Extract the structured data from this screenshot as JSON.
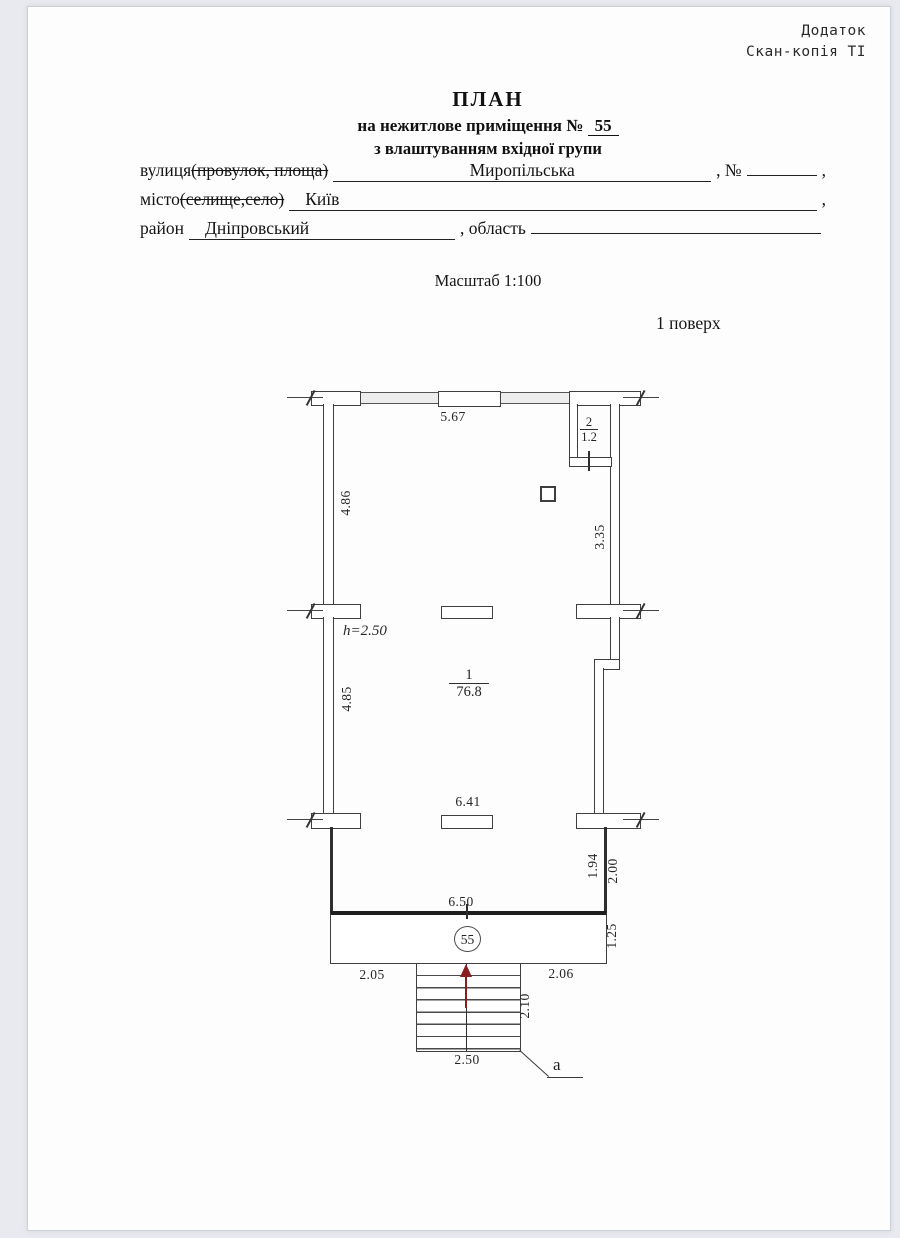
{
  "corner_note": {
    "line1": "Додаток",
    "line2": "Скан-копія ТІ"
  },
  "title": {
    "heading": "ПЛАН",
    "subtitle_prefix": "на нежитлове приміщення №",
    "premise_number": "55",
    "subtitle2": "з влаштуванням вхідної групи"
  },
  "form": {
    "street_label": "вулиця",
    "street_label_struck": "(провулок, площа)",
    "street_value": "Миропільська",
    "number_label": ", №",
    "comma": ",",
    "city_label": "місто",
    "city_label_struck": "(селище,село)",
    "city_value": "Київ",
    "district_label": "район",
    "district_value": "Дніпровський",
    "oblast_label": ", область"
  },
  "scale_label": "Масштаб 1:100",
  "floor_label": "1 поверх",
  "plan": {
    "room_main": {
      "number": "1",
      "area": "76.8"
    },
    "room_small": {
      "number": "2",
      "area": "1.2"
    },
    "height_note": "h=2.50",
    "premise_badge": "55",
    "entrance_mark": "а",
    "dims": {
      "top_width": "5.67",
      "left_upper": "4.86",
      "right_upper": "3.35",
      "left_lower": "4.85",
      "mid_width": "6.41",
      "right_inner": "1.94",
      "right_outer": "2.00",
      "vestibule_width": "6.50",
      "vestibule_depth": "1.25",
      "bottom_left": "2.05",
      "bottom_right": "2.06",
      "stairs_depth": "2.10",
      "stairs_width": "2.50"
    }
  },
  "colors": {
    "paper": "#fdfdfd",
    "backdrop": "#e8eaef",
    "ink": "#1c1c1c",
    "wall_line": "#3f3f3f",
    "arrow_red": "#8a1d1d"
  }
}
